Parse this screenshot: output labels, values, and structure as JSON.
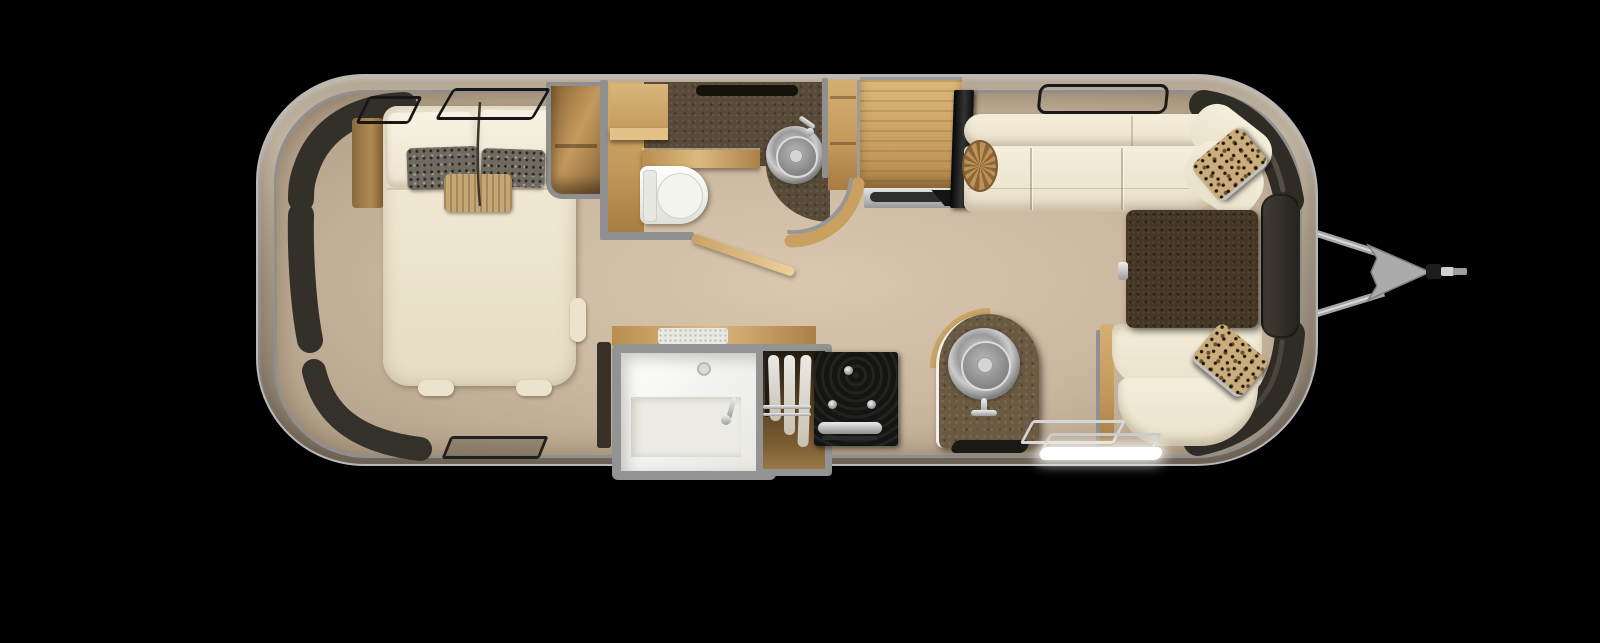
{
  "meta": {
    "title": "Travel trailer floor plan - top view 3D rendering",
    "scene": "airstream-style travel trailer floorplan on black background",
    "orientation": "hitch on right (front), bedroom on left (rear)"
  },
  "palette": {
    "background": "#000000",
    "shell_body": "#a89a87",
    "shell_rim": "#b8b8b8",
    "floor_tan": "#ccb9a1",
    "interior_wall_gray": "#909090",
    "window_tint": "#332f29",
    "wood_oak": "#c59a5e",
    "upholstery_cream": "#f1ead6",
    "bath_counter_brown": "#584a38",
    "table_brown": "#443625",
    "stove_black": "#141412",
    "metal_silver": "#b0b0b0",
    "step_glow": "#ffffff"
  },
  "trailer": {
    "hitch": {
      "side": "right",
      "parts": [
        "a-frame-arm-top",
        "a-frame-arm-bottom",
        "tongue-plate",
        "coupler",
        "jack-bar"
      ]
    },
    "windows": [
      "rear-left-corner-band-upper",
      "rear-left-side-band",
      "rear-left-corner-band-lower",
      "bedroom-open-window-large",
      "bedroom-open-window-small",
      "bedroom-bottom-window",
      "lounge-top-window",
      "front-right-corner-band",
      "front-right-side-window",
      "front-right-lower-band"
    ]
  },
  "rooms": {
    "bedroom": {
      "position": "left",
      "items": [
        "queen-bed",
        "king-pillow-left",
        "king-pillow-right",
        "gray-accent-pillow-left",
        "gray-accent-pillow-right",
        "tan-accent-pillow",
        "nightstand",
        "wardrobe-cabinet"
      ]
    },
    "bathroom": {
      "position": "center-top",
      "items": [
        "upper-cabinet",
        "side-wood-column",
        "vanity-counter-dark",
        "counter-front-strip",
        "round-lavatory-sink",
        "lav-faucet",
        "toilet",
        "curved-half-wall",
        "open-pocket-door",
        "vent-slot"
      ]
    },
    "shower-room": {
      "position": "center-bottom",
      "items": [
        "counter-top-strip",
        "skylight-inset",
        "shower-stall",
        "shower-bench",
        "shower-drain",
        "shower-wand",
        "linen-closet",
        "hanging-towels",
        "closet-rods"
      ]
    },
    "galley": {
      "position": "center",
      "items": [
        "range-stove",
        "stove-knobs",
        "oven-handle",
        "peninsula-counter-arch",
        "round-kitchen-sink",
        "kitchen-faucet",
        "floor-mat"
      ]
    },
    "lounge": {
      "position": "right",
      "items": [
        "sofa-top-backrest",
        "sofa-top-seat",
        "sofa-corner-cushion",
        "sofa-bottom-backrest",
        "sofa-bottom-seat",
        "sofa-side-wood-panel",
        "dinette-table",
        "table-mount-tab",
        "leopard-pillow-top",
        "leopard-pillow-bottom",
        "wicker-pouf",
        "tv-panel",
        "refrigerator-cabinet",
        "vent-grille"
      ]
    },
    "entry": {
      "position": "bottom-right",
      "items": [
        "entry-step-tread-1",
        "entry-step-tread-2",
        "led-step-light"
      ]
    }
  }
}
